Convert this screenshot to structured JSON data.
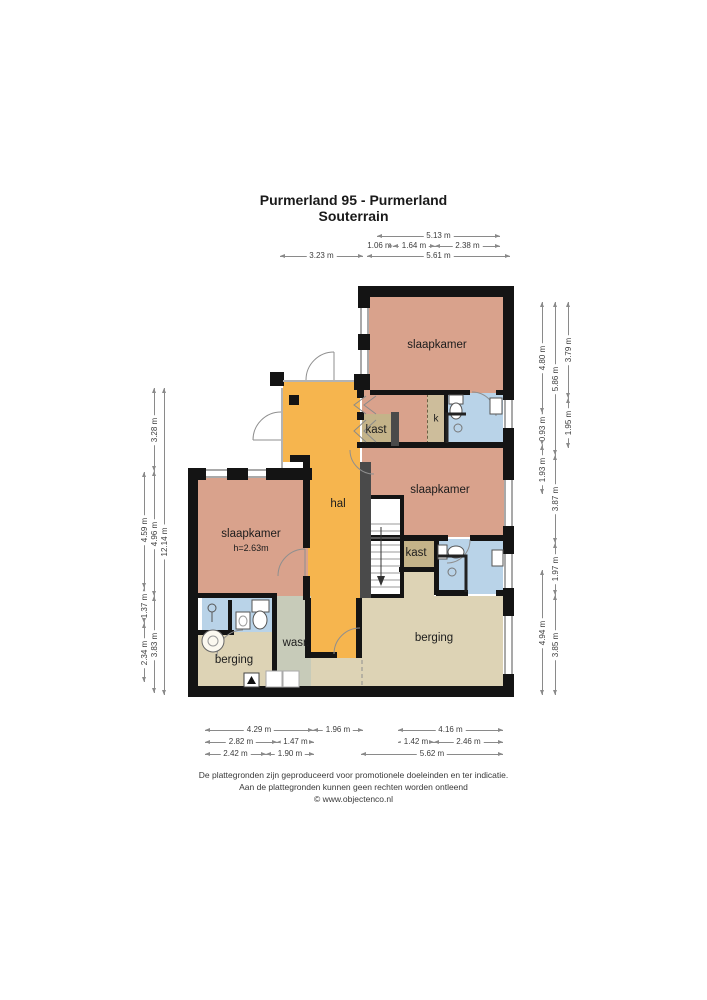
{
  "title": "Purmerland 95 - Purmerland",
  "subtitle": "Souterrain",
  "rooms": {
    "bedroom_top": "slaapkamer",
    "bedroom_mid": "slaapkamer",
    "bedroom_left": "slaapkamer",
    "bedroom_left_height": "h=2.63m",
    "hall": "hal",
    "closet_mid": "kast",
    "closet_small": "k",
    "closet_right": "kast",
    "laundry": "wasr.",
    "storage_left": "berging",
    "storage_right": "berging"
  },
  "dimensions": {
    "top": [
      "5.13 m",
      "1.06 m",
      "1.64 m",
      "2.38 m",
      "3.23 m",
      "5.61 m"
    ],
    "right": [
      "4.80 m",
      "0.93 m",
      "1.93 m",
      "4.94 m",
      "5.86 m",
      "3.87 m",
      "1.97 m",
      "3.85 m",
      "3.79 m",
      "1.95 m"
    ],
    "left": [
      "4.59 m",
      "1.37 m",
      "2.34 m",
      "3.28 m",
      "4.96 m",
      "3.83 m",
      "12.14 m"
    ],
    "bottom": [
      "4.29 m",
      "1.96 m",
      "4.16 m",
      "2.82 m",
      "1.47 m",
      "1.42 m",
      "2.46 m",
      "2.42 m",
      "1.90 m",
      "5.62 m"
    ]
  },
  "footer": {
    "line1": "De plattegronden zijn geproduceerd voor promotionele doeleinden en ter indicatie.",
    "line2": "Aan de plattegronden kunnen geen rechten worden ontleend",
    "line3": "© www.objectenco.nl"
  },
  "colors": {
    "bedroom": "#d9a28c",
    "hall": "#f6b54e",
    "storage": "#ddd3b5",
    "laundry": "#c7cbb9",
    "bathroom": "#b9d3e8",
    "closet": "#c4b389",
    "wall": "#141414"
  },
  "icons": {
    "stairs_direction": "down-arrow",
    "washing_machine": "washing-machine",
    "heater": "flame"
  }
}
